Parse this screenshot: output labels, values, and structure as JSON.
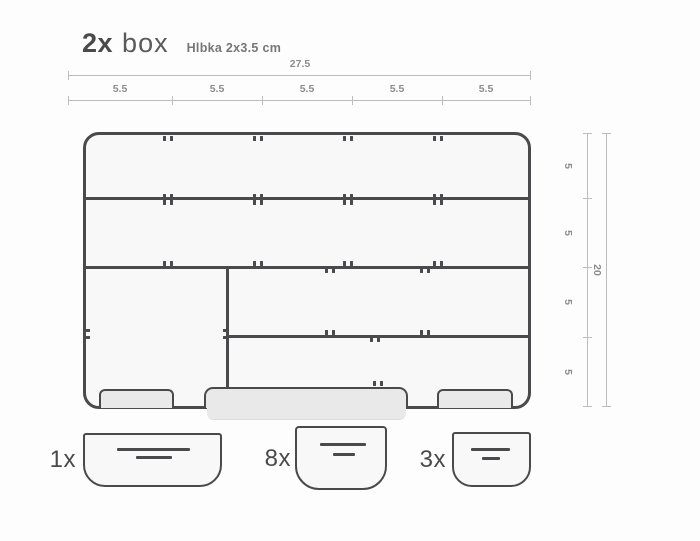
{
  "title": {
    "quantity": "2x",
    "product": "box",
    "subtitle": "Hlbka 2x3.5 cm"
  },
  "dimensions": {
    "top_total_label": "27.5",
    "top_segment_labels": [
      "5.5",
      "5.5",
      "5.5",
      "5.5",
      "5.5"
    ],
    "right_segment_labels": [
      "5",
      "5",
      "5",
      "5"
    ],
    "right_total_label": "20"
  },
  "pieces": [
    {
      "quantity_label": "1x"
    },
    {
      "quantity_label": "8x"
    },
    {
      "quantity_label": "3x"
    }
  ],
  "colors": {
    "stroke": "#4a4a4c",
    "box_fill": "#f8f8f8",
    "foot_fill": "#e9e9e9",
    "dimension_line": "#bdbdbd",
    "dimension_text": "#8c8c8c",
    "label_text": "#4a4a4c"
  }
}
